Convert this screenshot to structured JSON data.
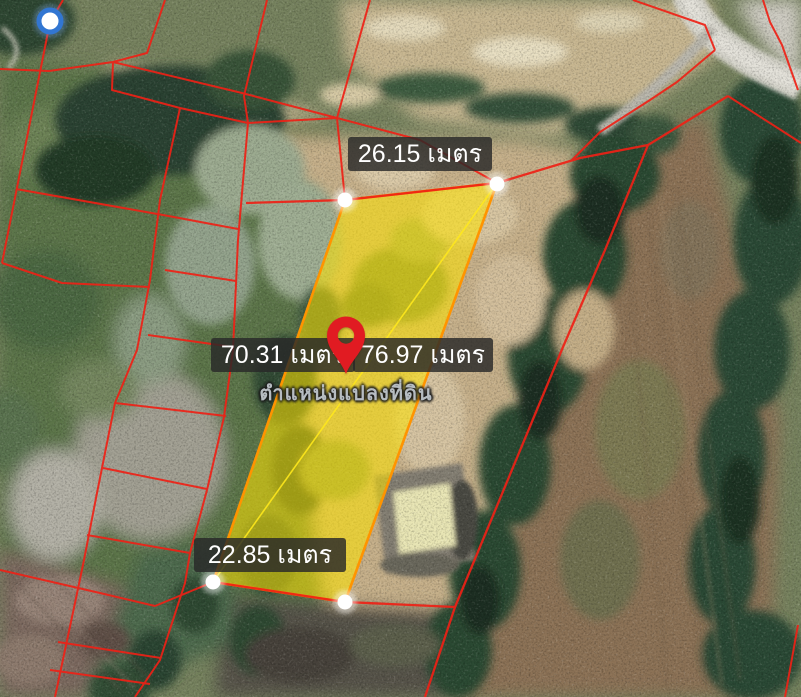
{
  "map": {
    "measurements": {
      "top_edge": "26.15 เมตร",
      "left_side": "70.31 เมตร",
      "right_side": "76.97 เมตร",
      "bottom_edge": "22.85 เมตร"
    },
    "caption": "ตำแหน่งแปลงที่ดิน",
    "colors": {
      "parcel_fill": "rgba(255,228,0,0.55)",
      "parcel_border": "#ff9400",
      "parcel_diagonal": "#ffe81c",
      "cadastral_line": "#ee2116",
      "pin": "#e11b22",
      "gps_ring": "#3276d2",
      "vertex_dot": "#ffffff",
      "label_background": "rgba(40,40,40,0.82)",
      "label_text": "#ffffff",
      "caption_text": "#b6bcc1"
    }
  }
}
